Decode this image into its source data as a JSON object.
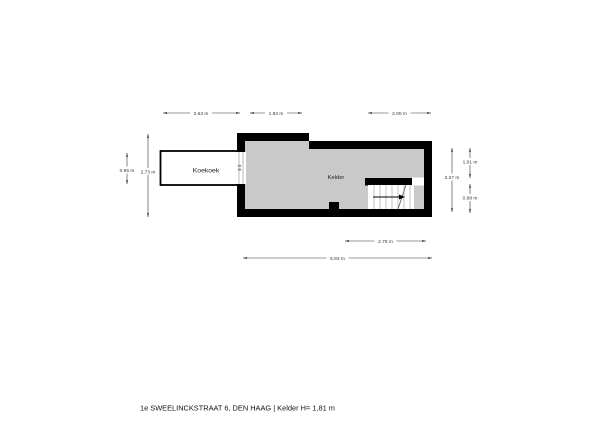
{
  "plan": {
    "rooms": {
      "koekoek": {
        "label": "Koekoek"
      },
      "kelder": {
        "label": "Kelder"
      }
    },
    "dimensions": {
      "top_left": "2.63 m",
      "top_middle": "1.82 m",
      "top_right": "2.00 m",
      "left_koekoek": "0.95 m",
      "left_total": "2.73 m",
      "right_total": "2.27 m",
      "right_upper": "1.01 m",
      "right_lower": "0.98 m",
      "bottom_stairs": "2.78 m",
      "bottom_total": "5.93 m"
    }
  },
  "footer": {
    "caption": "1e SWEELINCKSTRAAT 6, DEN HAAG  | Kelder H= 1,81 m"
  },
  "colors": {
    "wall": "#000000",
    "floor": "#c9c9c9",
    "background": "#ffffff",
    "dimension": "#333333"
  }
}
